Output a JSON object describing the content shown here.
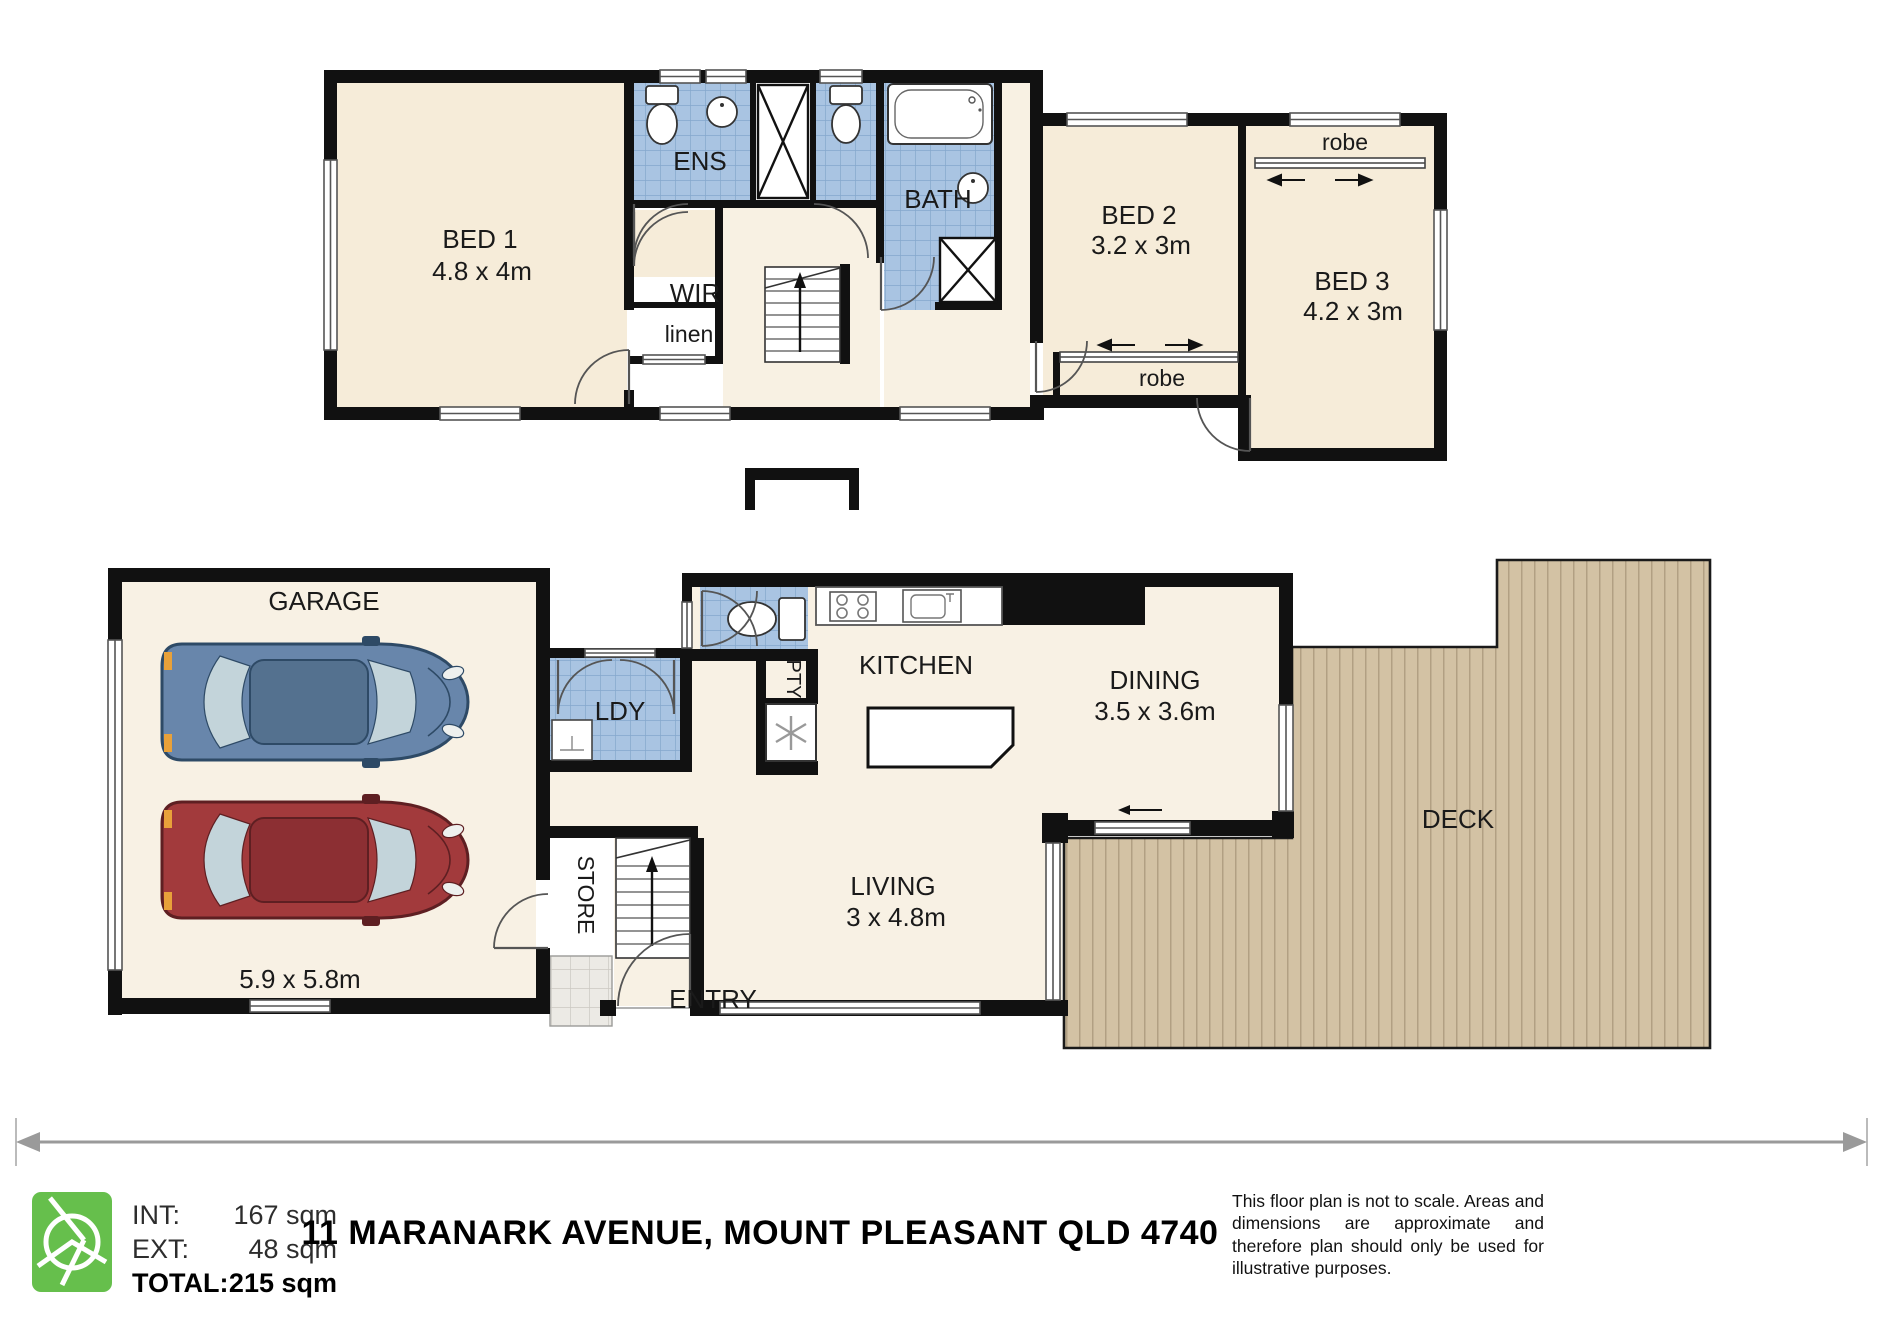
{
  "plan": {
    "upper": {
      "bed1": {
        "name": "BED 1",
        "dims": "4.8 x 4m"
      },
      "ens": "ENS",
      "wir": "WIR",
      "linen": "linen",
      "bath": "BATH",
      "bed2": {
        "name": "BED 2",
        "dims": "3.2 x 3m",
        "robe": "robe"
      },
      "bed3": {
        "name": "BED 3",
        "dims": "4.2 x 3m",
        "robe": "robe"
      }
    },
    "lower": {
      "garage": {
        "name": "GARAGE",
        "dims": "5.9 x 5.8m"
      },
      "ldy": "LDY",
      "store": "STORE",
      "entry": "ENTRY",
      "pty": "PTY",
      "kitchen": "KITCHEN",
      "dining": {
        "name": "DINING",
        "dims": "3.5 x 3.6m"
      },
      "living": {
        "name": "LIVING",
        "dims": "3 x 4.8m"
      },
      "deck": "DECK"
    }
  },
  "footer": {
    "areas": {
      "int_label": "INT:",
      "int_value": "167 sqm",
      "ext_label": "EXT:",
      "ext_value": "48 sqm",
      "total_label": "TOTAL:",
      "total_value": "215 sqm"
    },
    "address": "11 MARANARK AVENUE, MOUNT PLEASANT QLD 4740",
    "disclaimer": "This floor plan is not to scale. Areas and dimensions are approximate and therefore plan should only be used for illustrative purposes."
  },
  "colors": {
    "wall": "#111111",
    "room_fill": "#f6ecd9",
    "tile_blue": "#a9c4e2",
    "deck_tan": "#d3c2a4",
    "porch_grey": "#e9e7e2",
    "logo_green": "#66bf4c"
  }
}
